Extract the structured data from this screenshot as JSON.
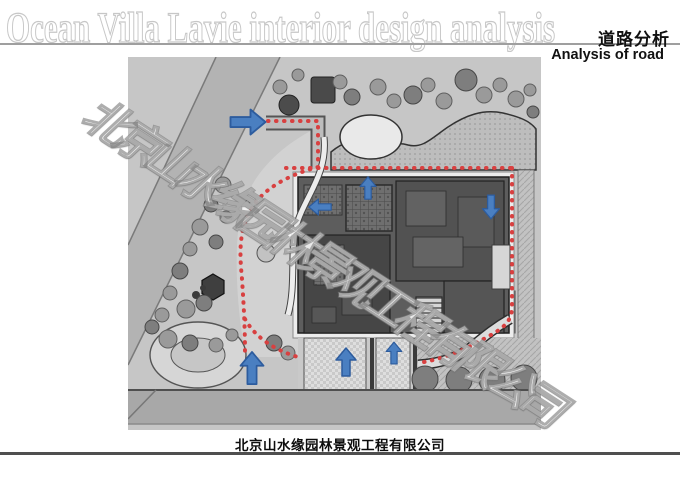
{
  "header": {
    "title": "Ocean Villa Lavie interior design analysis",
    "analysis_label_cn": "道路分析",
    "analysis_label_en": "Analysis of road"
  },
  "watermark": {
    "text": "北京山水缘园林景观工程有限公司"
  },
  "footer": {
    "company": "北京山水缘园林景观工程有限公司"
  },
  "plan": {
    "type": "landscape-site-plan-road-analysis",
    "route_style": "red-dotted-line",
    "arrows": [
      {
        "id": "west-entry-arrow",
        "direction": "right"
      },
      {
        "id": "courtyard-north-arrow",
        "direction": "up"
      },
      {
        "id": "courtyard-west-arrow",
        "direction": "left"
      },
      {
        "id": "courtyard-east-arrow",
        "direction": "down"
      },
      {
        "id": "south-entry-west-arrow",
        "direction": "up"
      },
      {
        "id": "south-entry-center-arrow",
        "direction": "up"
      },
      {
        "id": "south-entry-east-arrow",
        "direction": "up"
      }
    ]
  },
  "colors": {
    "accent-blue": "#4a7fc1",
    "arrow-border": "#2d5c9e",
    "route-red": "#d84040",
    "plan-bg": "#c6c6c6",
    "road-gray": "#b3b3b3",
    "building-gray": "#5d5d5d",
    "line-dark": "#4f4f4f",
    "line-light": "#9f9f9f"
  }
}
